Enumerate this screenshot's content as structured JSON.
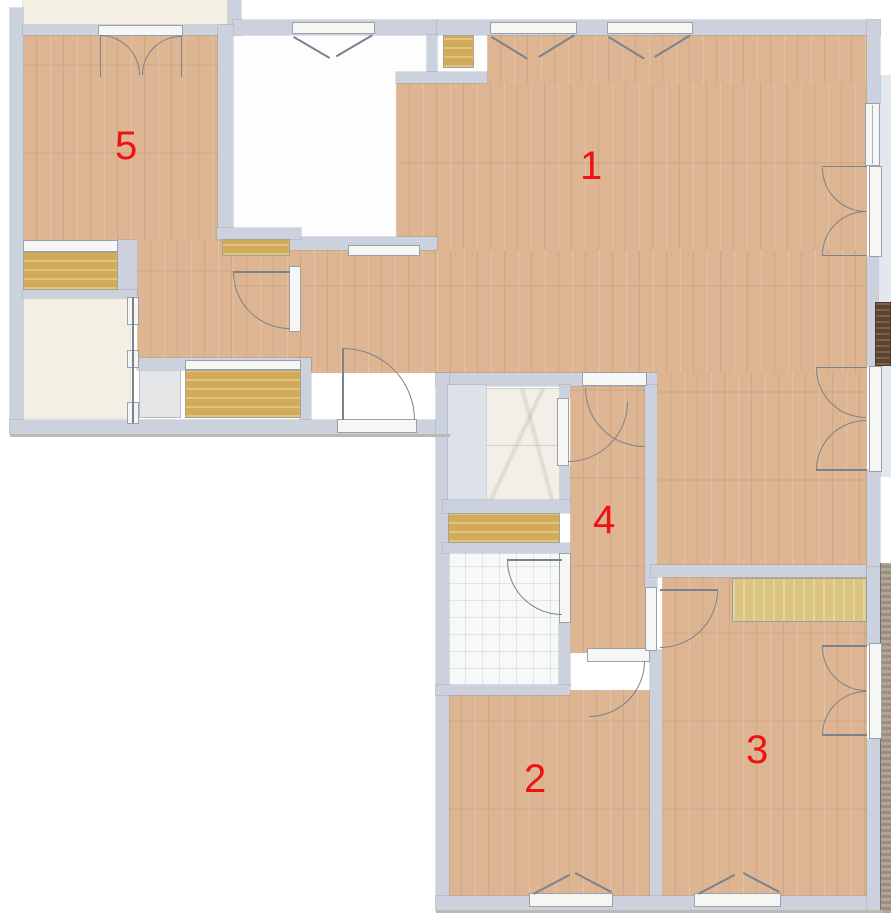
{
  "palette": {
    "wall": "#cbd2de",
    "wood_floor": "#ddb593",
    "cabinet_wood": "#d3aa58",
    "wardrobe_wood": "#dcc57f",
    "dark_wood": "#6a4c36",
    "marble": "#f2efe8",
    "tile": "#f7f8f8",
    "cream": "#f3efe2",
    "label_red": "#ee1212"
  },
  "label_color": "#ee1212",
  "rooms": [
    {
      "label": "1",
      "x": 580,
      "y": 146
    },
    {
      "label": "2",
      "x": 524,
      "y": 759
    },
    {
      "label": "3",
      "x": 746,
      "y": 730
    },
    {
      "label": "4",
      "x": 593,
      "y": 500
    },
    {
      "label": "5",
      "x": 115,
      "y": 126
    }
  ]
}
